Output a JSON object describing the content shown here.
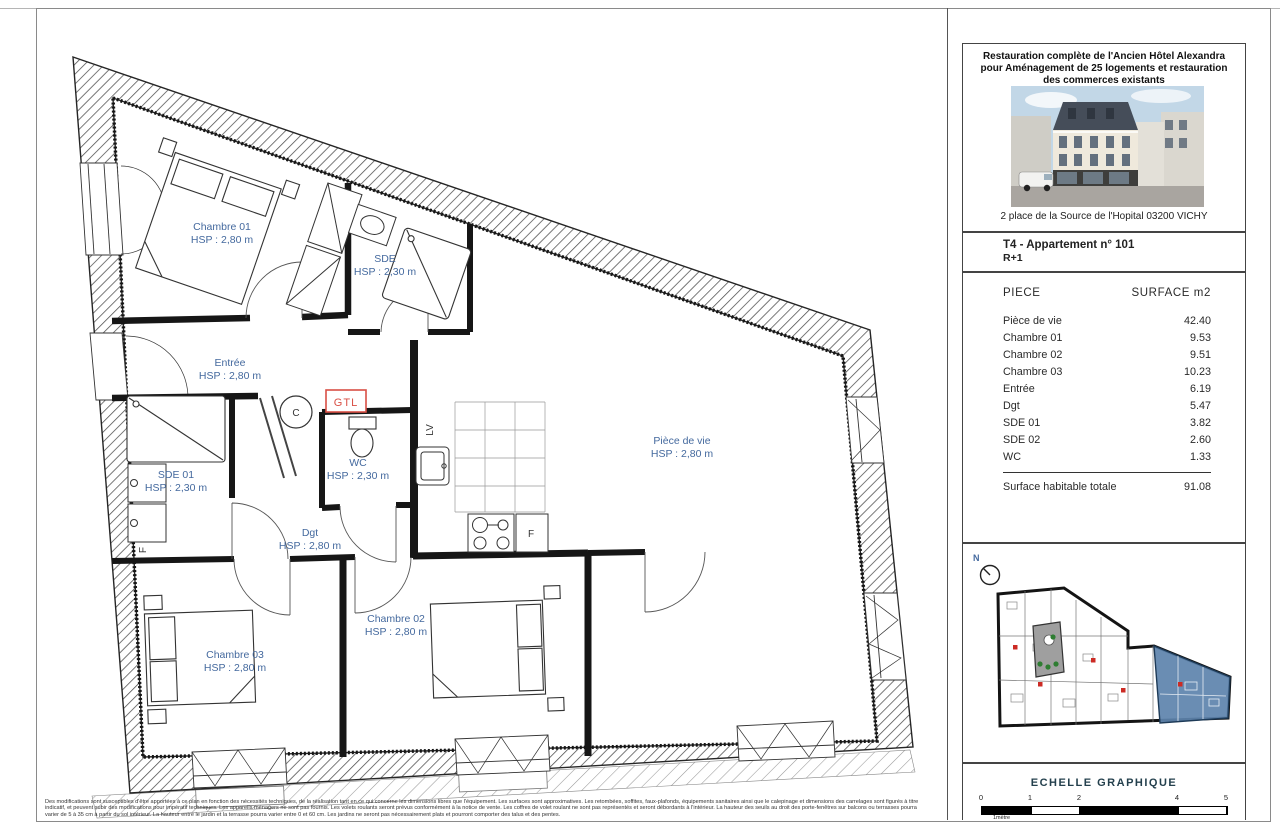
{
  "plan": {
    "rooms": [
      {
        "name": "Chambre 01",
        "hsp": "HSP : 2,80 m"
      },
      {
        "name": "SDE",
        "hsp": "HSP : 2,30 m"
      },
      {
        "name": "Entrée",
        "hsp": "HSP : 2,80 m"
      },
      {
        "name": "SDE 01",
        "hsp": "HSP : 2,30 m"
      },
      {
        "name": "WC",
        "hsp": "HSP : 2,30 m"
      },
      {
        "name": "Dgt",
        "hsp": "HSP : 2,80 m"
      },
      {
        "name": "Pièce de vie",
        "hsp": "HSP : 2,80 m"
      },
      {
        "name": "Chambre 02",
        "hsp": "HSP : 2,80 m"
      },
      {
        "name": "Chambre 03",
        "hsp": "HSP : 2,80 m"
      }
    ],
    "annotations": {
      "gtl": "GTL",
      "water_heater": "C",
      "dishwasher": "LV",
      "fridge": "F",
      "appliance": "F"
    },
    "colors": {
      "room_label": "#44699e",
      "gtl_red": "#d94f45",
      "keyplan_highlight": "#5d83ad",
      "keyplan_courtyard": "#9f9f9f",
      "keyplan_green": "#2e7d32",
      "keyplan_red": "#cc2b24"
    }
  },
  "title_block": {
    "project_title_lines": [
      "Restauration complète de l'Ancien Hôtel Alexandra",
      "pour Aménagement de 25 logements et restauration",
      "des commerces existants"
    ],
    "address": "2 place de la Source de l'Hopital 03200 VICHY",
    "apartment": {
      "line1": "T4 - Appartement n° 101",
      "line2": "R+1"
    }
  },
  "surface_table": {
    "col_room": "PIECE",
    "col_surface": "SURFACE m2",
    "rows": [
      [
        "Pièce de vie",
        "42.40"
      ],
      [
        "Chambre 01",
        "9.53"
      ],
      [
        "Chambre 02",
        "9.51"
      ],
      [
        "Chambre 03",
        "10.23"
      ],
      [
        "Entrée",
        "6.19"
      ],
      [
        "Dgt",
        "5.47"
      ],
      [
        "SDE 01",
        "3.82"
      ],
      [
        "SDE 02",
        "2.60"
      ],
      [
        "WC",
        "1.33"
      ]
    ],
    "total_label": "Surface habitable totale",
    "total_value": "91.08"
  },
  "key_plan": {
    "north_label": "N"
  },
  "scale": {
    "title": "ECHELLE GRAPHIQUE",
    "ticks": [
      "0",
      "1",
      "2",
      "4",
      "5"
    ],
    "unit_label": "1mètre"
  },
  "disclaimer": {
    "lines": [
      "Des modifications sont susceptibles d'être apportées à ce plan en fonction des nécessités techniques, de la réalisation tant en ce qui concerne les dimensions libres que l'équipement. Les surfaces sont approximatives. Les retombées, soffites, faux-plafonds, équipements sanitaires ainsi que le calepinage et dimensions des carrelages sont figurés à titre",
      "indicatif, et peuvent subir des modifications pour impératif techniques. Les appareils ménagers ne sont pas fournis. Les volets roulants seront prévus conformément à la notice de vente. Les coffres de volet roulant ne sont pas représentés et seront débordants à l'intérieur. La hauteur des seuils au droit des porte-fenêtres sur balcons ou terrasses pourra",
      "varier de 5 à 35 cm à partir du sol intérieur. La hauteur entre le jardin et la terrasse pourra varier entre 0 et 60 cm. Les jardins ne seront pas nécessairement plats et pourront comporter des talus et des pentes."
    ]
  }
}
